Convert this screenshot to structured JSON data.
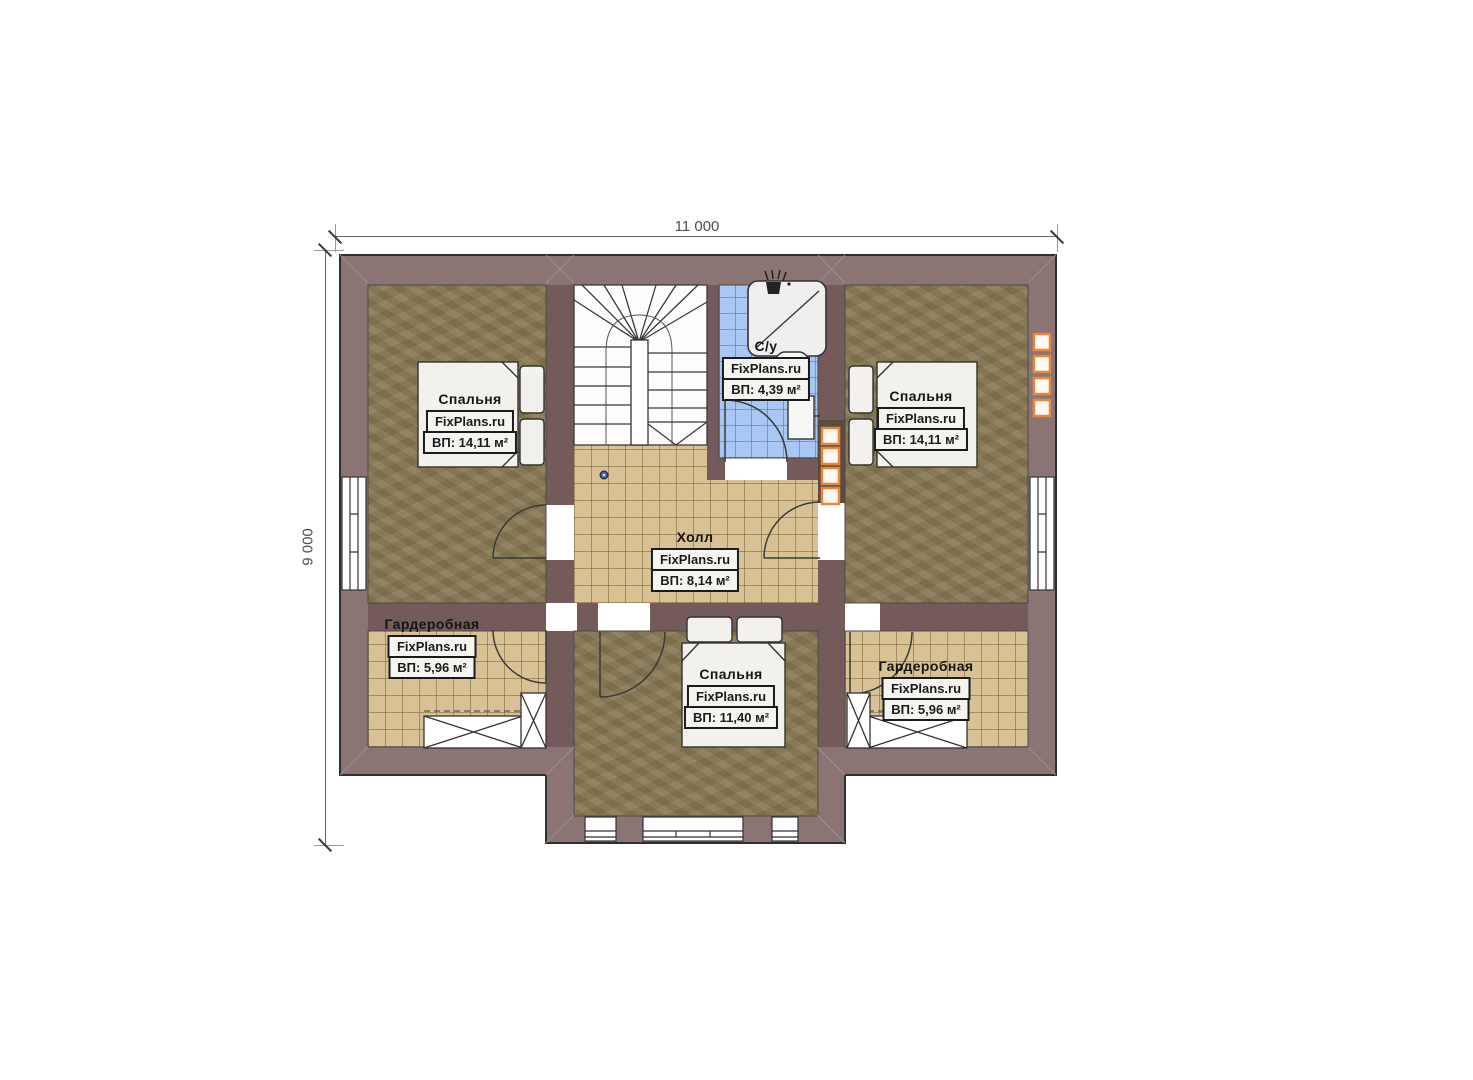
{
  "page": {
    "type": "floor-plan",
    "background": "#ffffff"
  },
  "watermark": "FixPlans.ru",
  "dimensions": {
    "width_label": "11 000",
    "height_label": "9 000"
  },
  "rooms": {
    "bedroom_left": {
      "name": "Спальня",
      "site": "FixPlans.ru",
      "area": "ВП: 14,11 м²"
    },
    "bathroom": {
      "name": "С/у",
      "site": "FixPlans.ru",
      "area": "ВП: 4,39 м²"
    },
    "bedroom_right": {
      "name": "Спальня",
      "site": "FixPlans.ru",
      "area": "ВП: 14,11 м²"
    },
    "hall": {
      "name": "Холл",
      "site": "FixPlans.ru",
      "area": "ВП: 8,14 м²"
    },
    "wardrobe_left": {
      "name": "Гардеробная",
      "site": "FixPlans.ru",
      "area": "ВП: 5,96 м²"
    },
    "bedroom_bottom": {
      "name": "Спальня",
      "site": "FixPlans.ru",
      "area": "ВП: 11,40 м²"
    },
    "wardrobe_right": {
      "name": "Гардеробная",
      "site": "FixPlans.ru",
      "area": "ВП: 5,96 м²"
    }
  },
  "colors": {
    "outer_wall": "#8c7474",
    "inner_wall": "#745a5b",
    "vent_wall": "#5d4a41",
    "bedroom_floor": "#877753",
    "tile_floor": "#d8c295",
    "bathroom_tile": "#a8c7f2",
    "vent_accent": "#e8863a",
    "dimension_text": "#4f4f4f"
  }
}
